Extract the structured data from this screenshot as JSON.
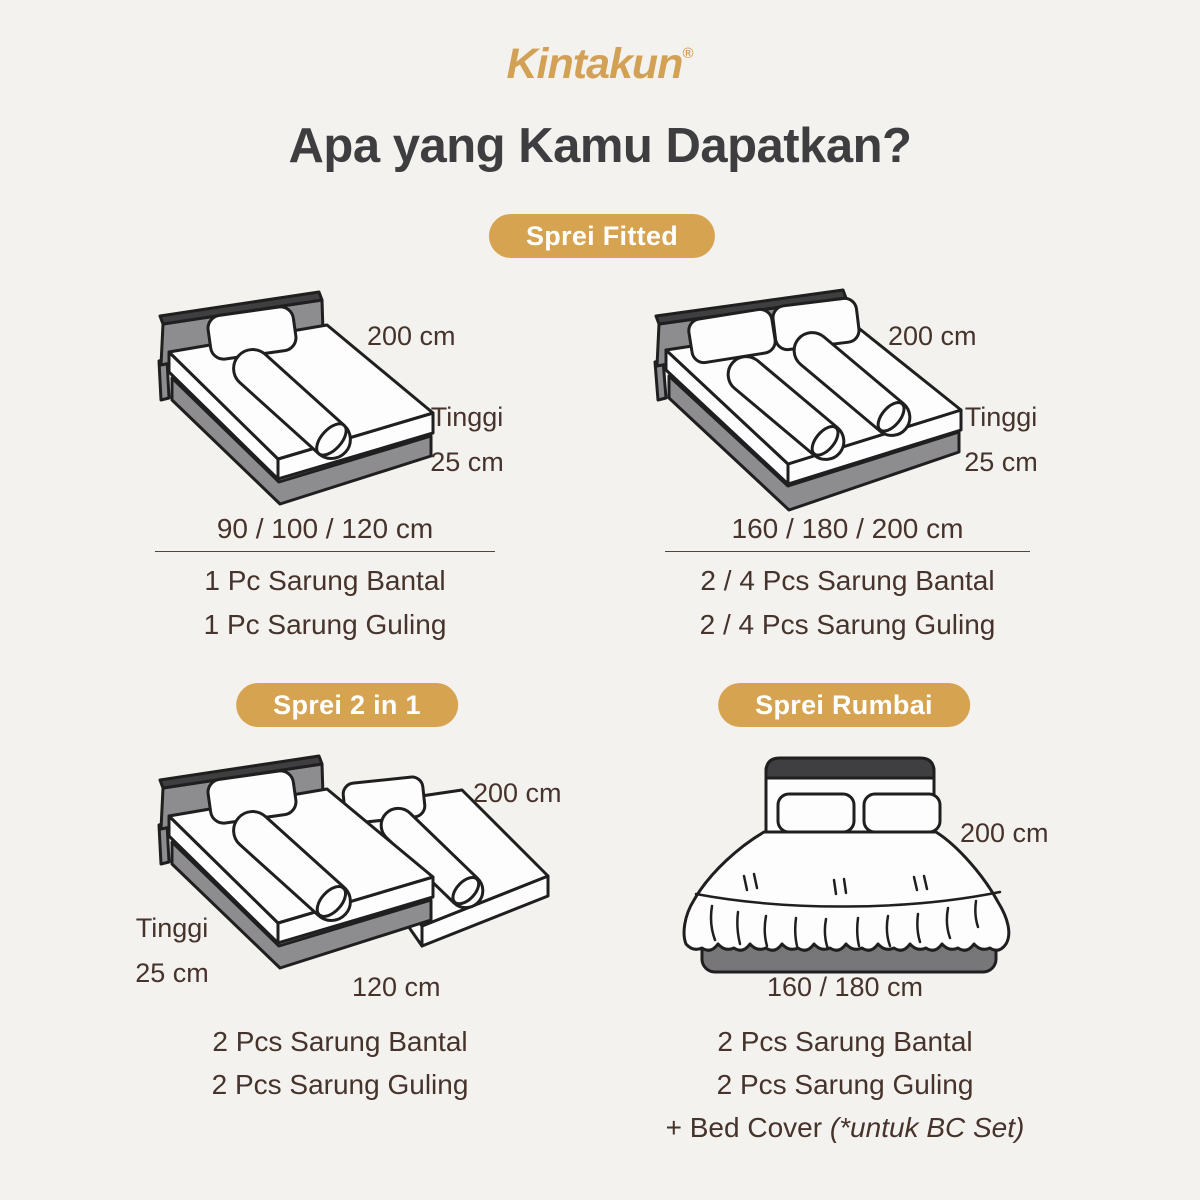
{
  "canvas": {
    "width": 1200,
    "height": 1200,
    "background": "#F4F2EE"
  },
  "colors": {
    "accent_gold": "#D6A350",
    "logo_gold": "#D3A155",
    "title_color": "#3E3E40",
    "text_color": "#45332C",
    "badge_text": "#FFFFFF",
    "bed_gray": "#8D8D8F",
    "bed_outline": "#1F1F1F"
  },
  "brand": {
    "name": "Kintakun",
    "registered_mark": "®"
  },
  "title": "Apa yang Kamu Dapatkan?",
  "illustrations": {
    "bed1": "single-bed-isometric",
    "bed2": "double-bed-isometric",
    "bed3": "two-in-one-bed-isometric",
    "bed4": "rumbai-bed-front-view"
  },
  "sections": [
    {
      "badge": "Sprei Fitted",
      "variants": [
        {
          "length": "200 cm",
          "height_label": "Tinggi",
          "height": "25 cm",
          "sizes": "90 / 100 / 120 cm",
          "items": [
            "1 Pc Sarung Bantal",
            "1 Pc Sarung Guling"
          ]
        },
        {
          "length": "200 cm",
          "height_label": "Tinggi",
          "height": "25 cm",
          "sizes": "160 / 180 / 200 cm",
          "items": [
            "2 / 4 Pcs Sarung Bantal",
            "2 / 4 Pcs Sarung Guling"
          ]
        }
      ]
    },
    {
      "badge": "Sprei 2 in 1",
      "variants": [
        {
          "length": "200 cm",
          "height_label": "Tinggi",
          "height": "25 cm",
          "width": "120 cm",
          "items": [
            "2 Pcs Sarung Bantal",
            "2 Pcs Sarung Guling"
          ]
        }
      ]
    },
    {
      "badge": "Sprei Rumbai",
      "variants": [
        {
          "length": "200 cm",
          "width": "160 / 180 cm",
          "items": [
            "2 Pcs Sarung Bantal",
            "2 Pcs Sarung Guling"
          ],
          "note": "+ Bed Cover ",
          "note_italic": "(*untuk BC Set)"
        }
      ]
    }
  ]
}
